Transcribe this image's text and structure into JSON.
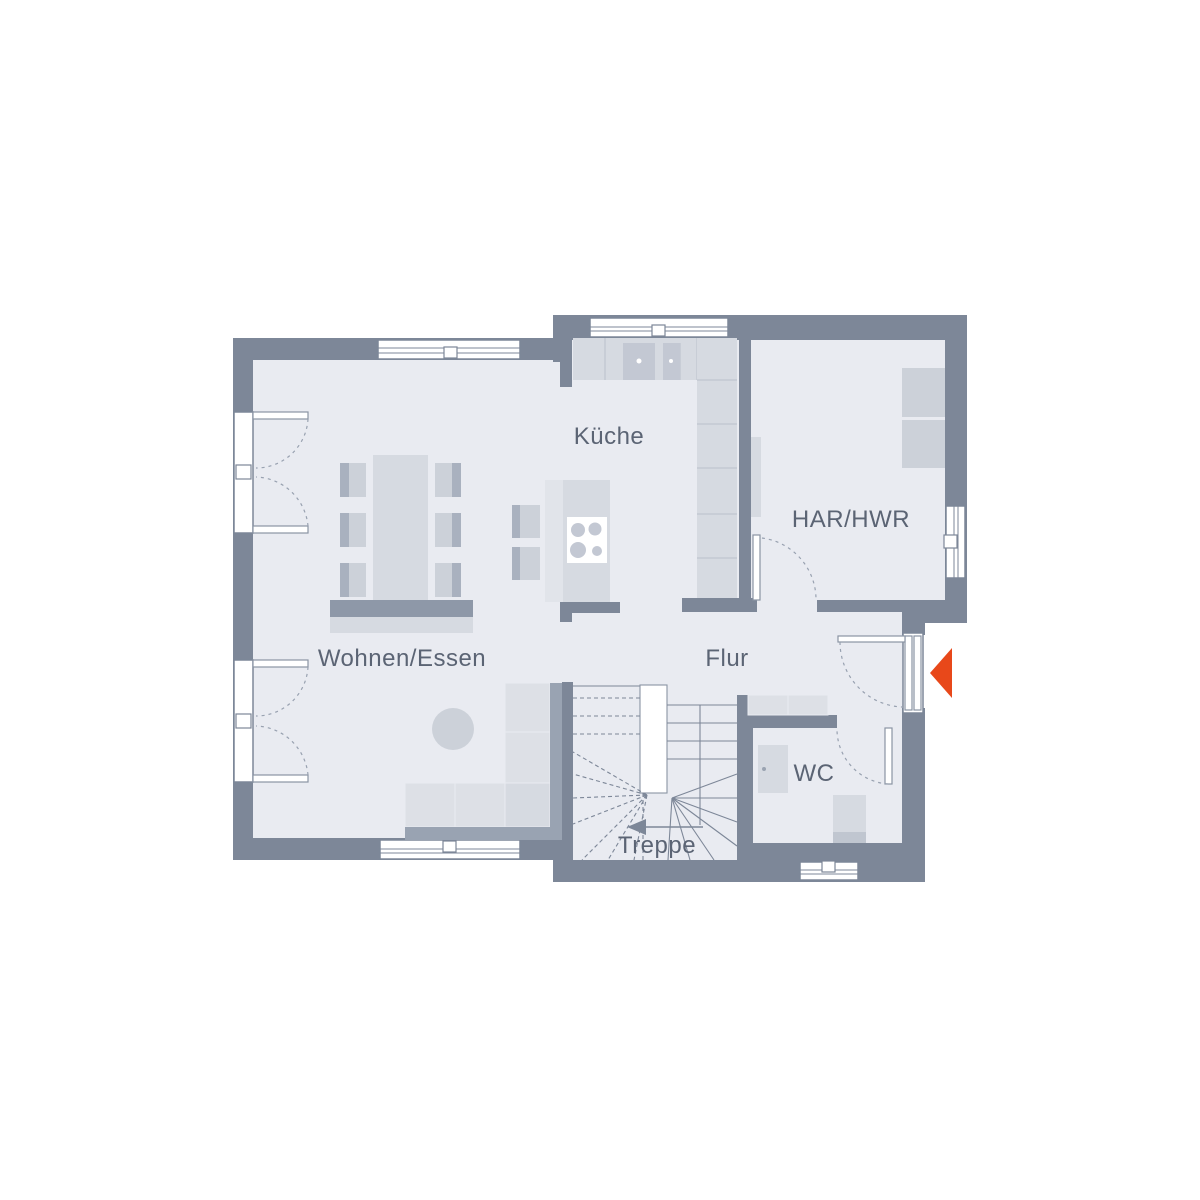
{
  "floorplan": {
    "rooms": {
      "kueche": {
        "label": "Küche"
      },
      "har_hwr": {
        "label": "HAR/HWR"
      },
      "wohnen_essen": {
        "label": "Wohnen/Essen"
      },
      "flur": {
        "label": "Flur"
      },
      "wc": {
        "label": "WC"
      },
      "treppe": {
        "label": "Treppe"
      }
    },
    "entrance": {
      "marker": "left-pointing-triangle"
    },
    "colors": {
      "wall": "#7d8798",
      "floor": "#e9ebf1",
      "furniture_light": "#dde0e6",
      "furniture_medium": "#ccd1d9",
      "accent_entrance_arrow": "#e8481a",
      "label_text": "#5b6474",
      "background": "#ffffff"
    }
  }
}
